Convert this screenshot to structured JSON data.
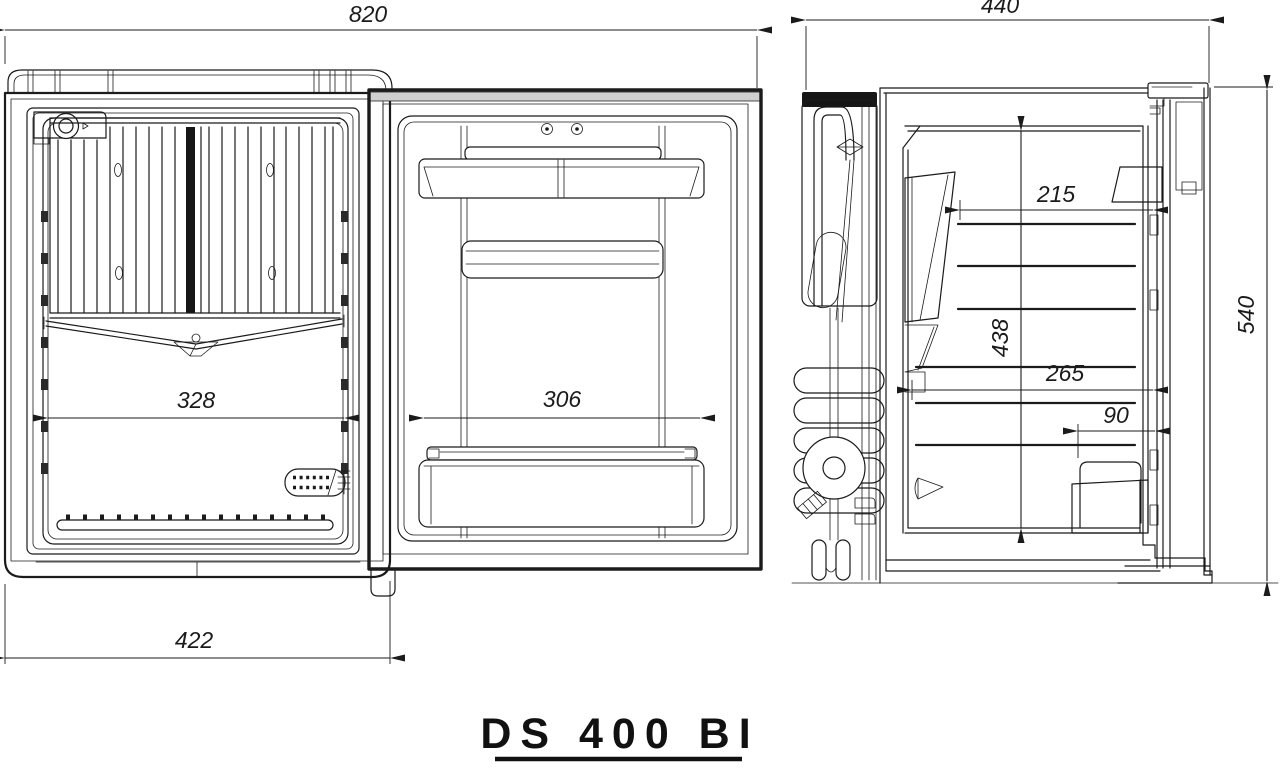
{
  "drawing": {
    "model_label": "DS 400 BI",
    "colors": {
      "line": "#1b1b1b",
      "background": "#ffffff",
      "dark_fill": "#161616"
    },
    "front_view": {
      "dims": {
        "overall_width": "820",
        "cabinet_width": "422",
        "interior_width": "328",
        "door_liner_width": "306"
      }
    },
    "side_view": {
      "dims": {
        "overall_depth": "440",
        "overall_height": "540",
        "upper_interior_depth": "215",
        "interior_height": "438",
        "lower_interior_depth": "265",
        "door_bin_depth": "90"
      }
    }
  }
}
